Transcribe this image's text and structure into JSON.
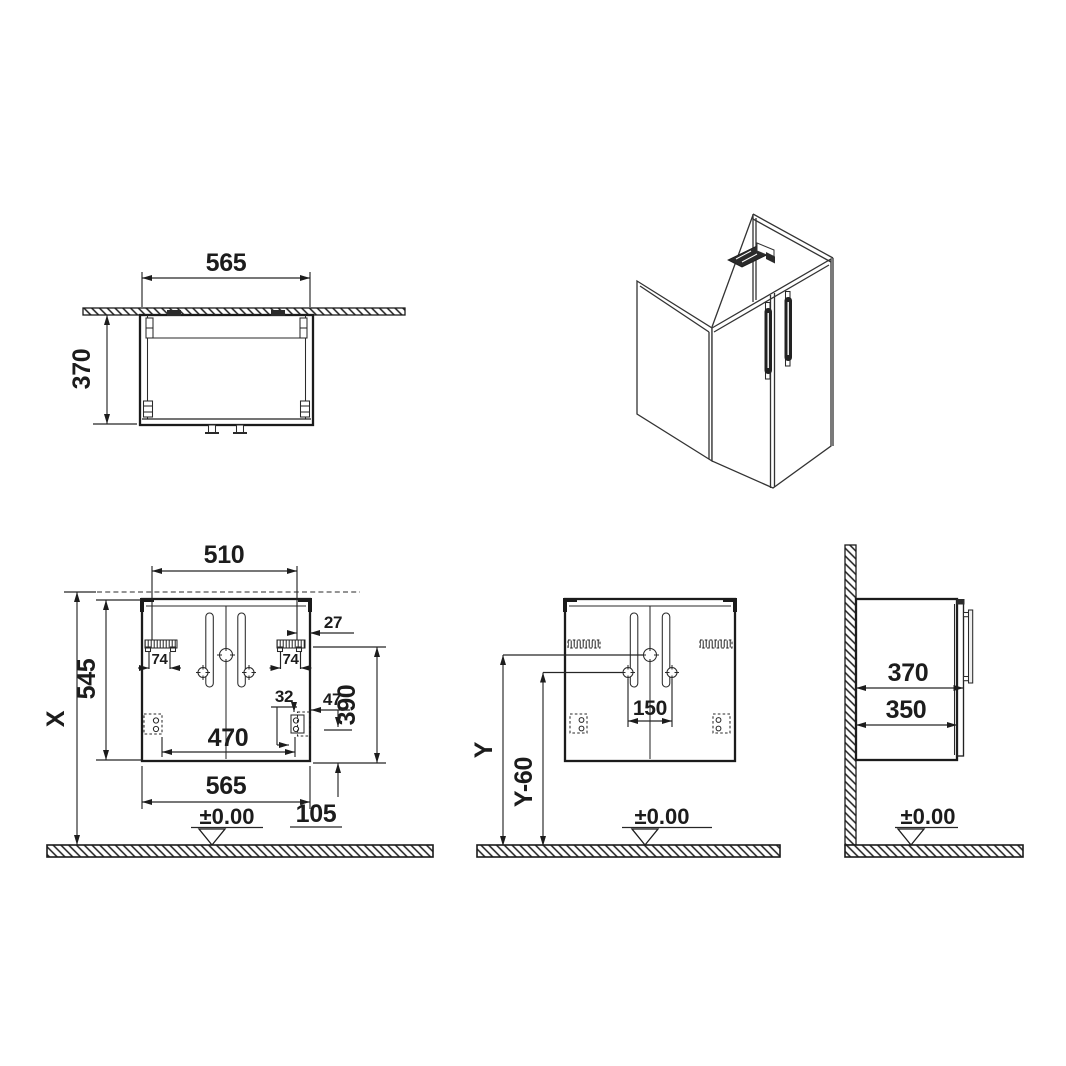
{
  "drawing": {
    "background": "#ffffff",
    "ink": "#1c1c1c",
    "views": {
      "top": {
        "width": "565",
        "depth": "370"
      },
      "rear": {
        "hanger_pitch": "510",
        "floor_to_top": "X",
        "carcass_height": "545",
        "hanger_left_width": "74",
        "hanger_right_width": "74",
        "hanger_edge_offset": "27",
        "hanger_to_bottom": "390",
        "fixing_width": "32",
        "fixing_drop": "47",
        "bottom_fixing_pitch": "470",
        "carcass_width": "565",
        "bottom_fixing_offset": "105",
        "floor_datum": "±0.00"
      },
      "front": {
        "handle_pitch": "150",
        "mount_height": "Y",
        "mount_height_lower": "Y-60",
        "floor_datum": "±0.00"
      },
      "side": {
        "depth_overall": "370",
        "carcass_depth": "350",
        "floor_datum": "±0.00"
      }
    }
  }
}
